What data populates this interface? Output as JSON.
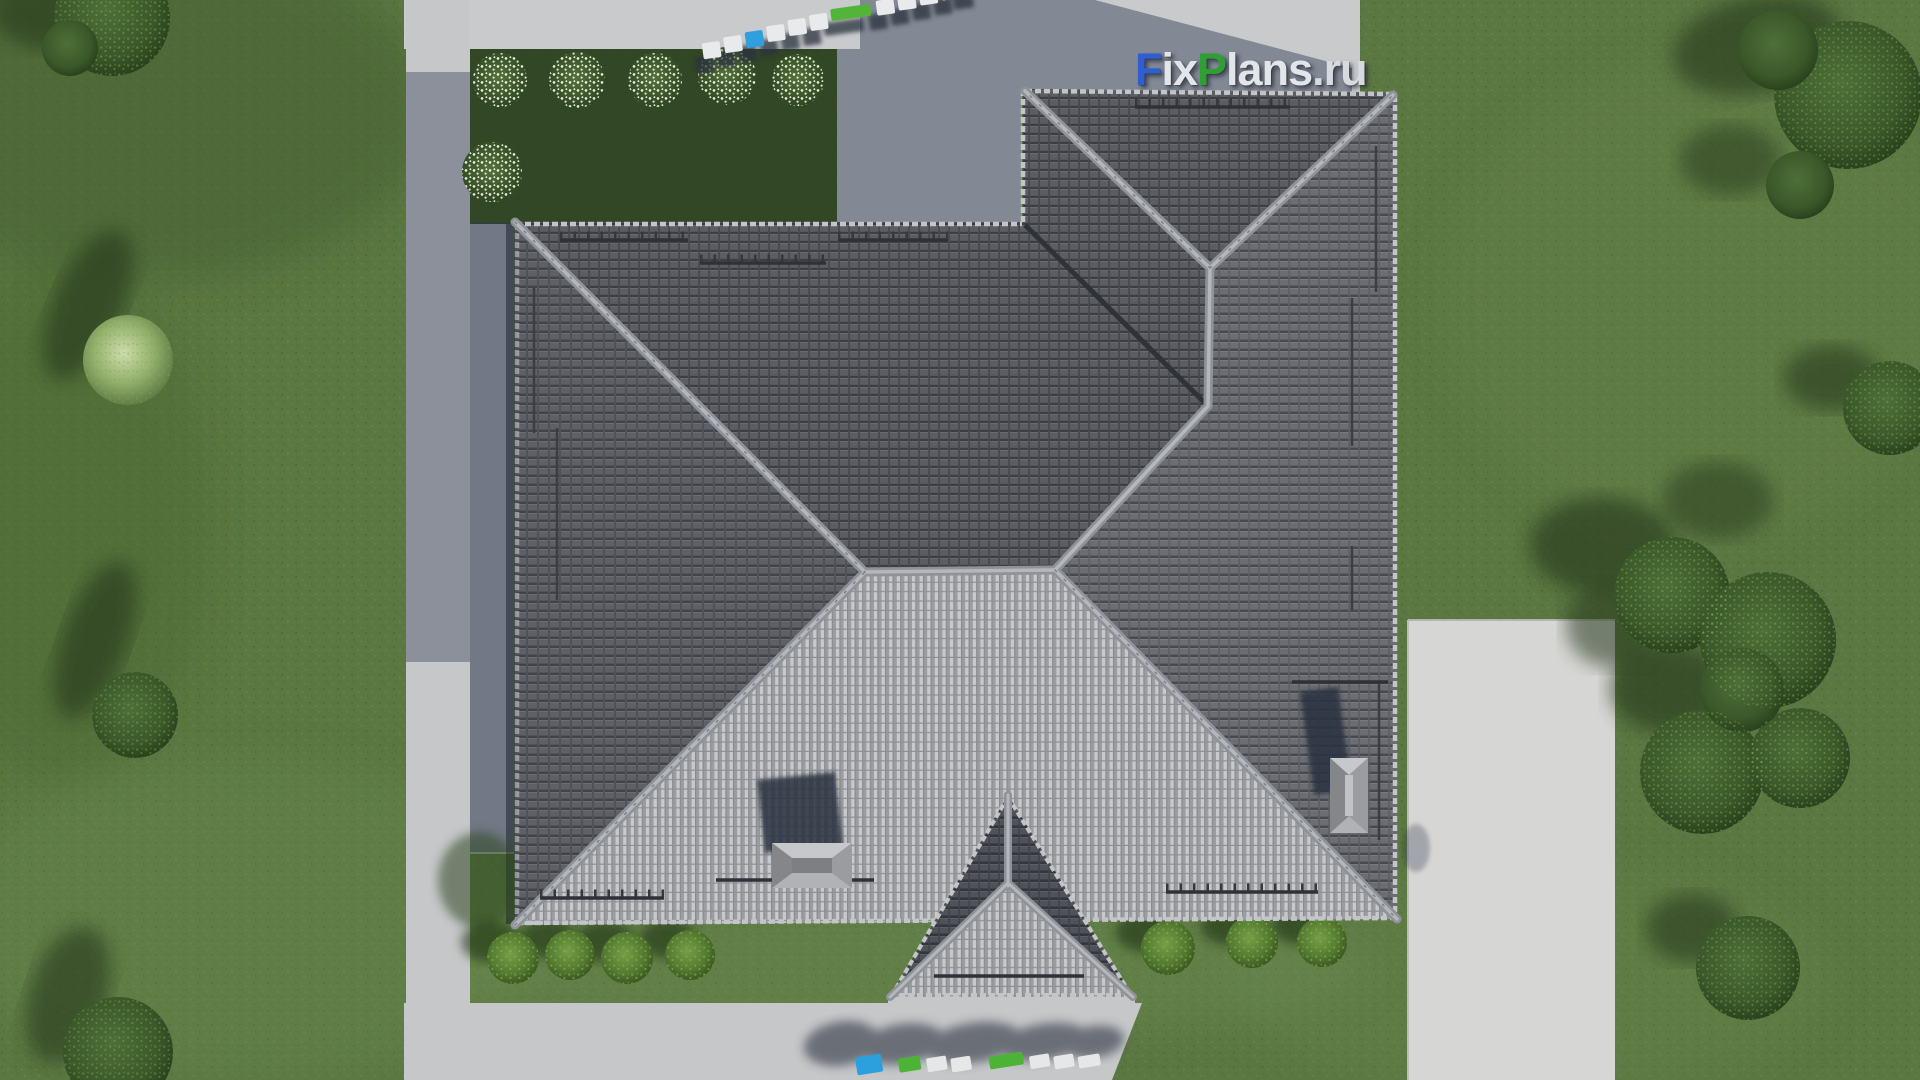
{
  "scene": {
    "title": "Aerial top-down 3D render of a single-family house with a gray hip tile roof",
    "setting": "green lawn with trees, shrubs, flower bushes, concrete paths and a driveway"
  },
  "watermarks": {
    "main": {
      "full": "FixPlans.ru",
      "parts": [
        {
          "t": "F"
        },
        {
          "t": "ix"
        },
        {
          "t": "P"
        },
        {
          "t": "lans"
        },
        {
          "t": ".ru"
        }
      ]
    },
    "top_3d": "FixPlans.ru",
    "bottom_3d": "FixPlans.ru"
  },
  "palette": {
    "grass": "#5b7742",
    "grass_shadow": "#2f4722",
    "back_lawn_dark": "#24371b",
    "pavement": "#c9cacc",
    "driveway": "#d6d6d4",
    "roof_dark_face": "#5b5d63",
    "roof_medium_face": "#6b6d73",
    "roof_sunlit_face": "#b9babe",
    "ridge_cap": "#a6a9ae",
    "valley": "#2f3237",
    "cast_shadow": "#2d3750",
    "watermark_blue": "#2e5fd0",
    "watermark_green": "#2f9e35",
    "watermark_white": "#e2e5ea"
  }
}
